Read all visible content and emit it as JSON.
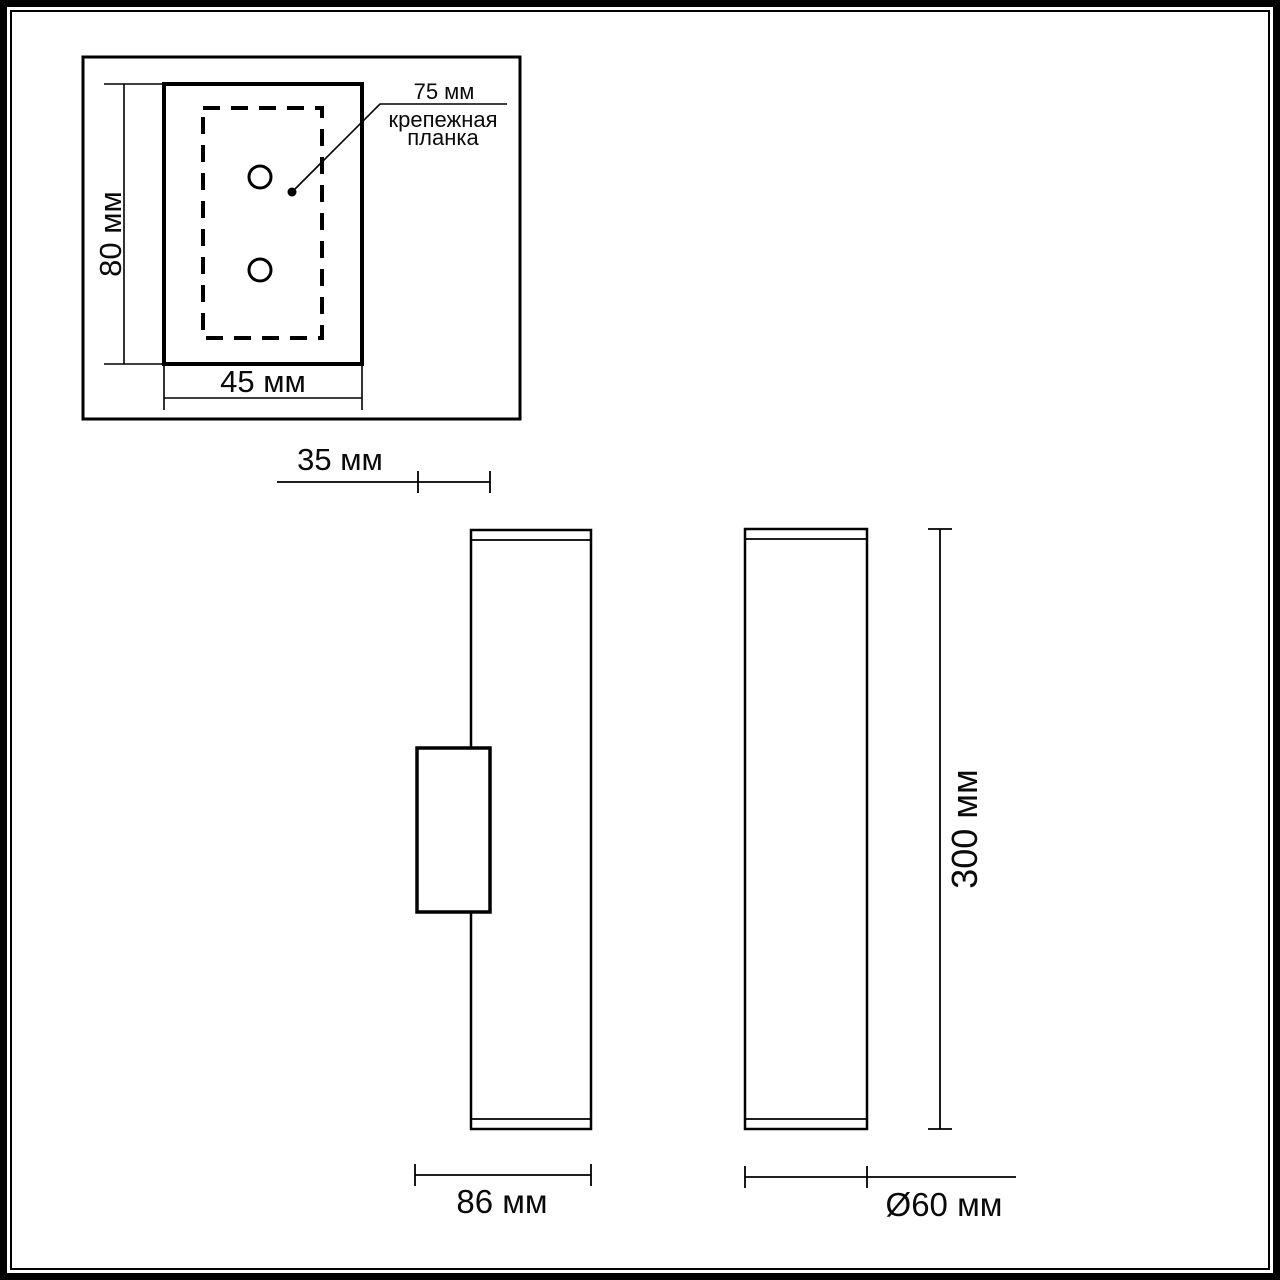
{
  "drawing": {
    "kind": "technical dimension drawing of wall lamp",
    "units": "мм",
    "colors": {
      "line": "#000000",
      "background": "#ffffff",
      "text": "#0a0a0a"
    },
    "detail_view": {
      "plate_height_label": "80 мм",
      "plate_width_label": "45 мм",
      "callout_value": "75 мм",
      "callout_name_line1": "крепежная",
      "callout_name_line2": "планка"
    },
    "side_view": {
      "bracket_depth_label": "35 мм",
      "total_depth_label": "86 мм"
    },
    "front_view": {
      "height_label": "300 мм",
      "diameter_label": "Ø60 мм"
    }
  }
}
